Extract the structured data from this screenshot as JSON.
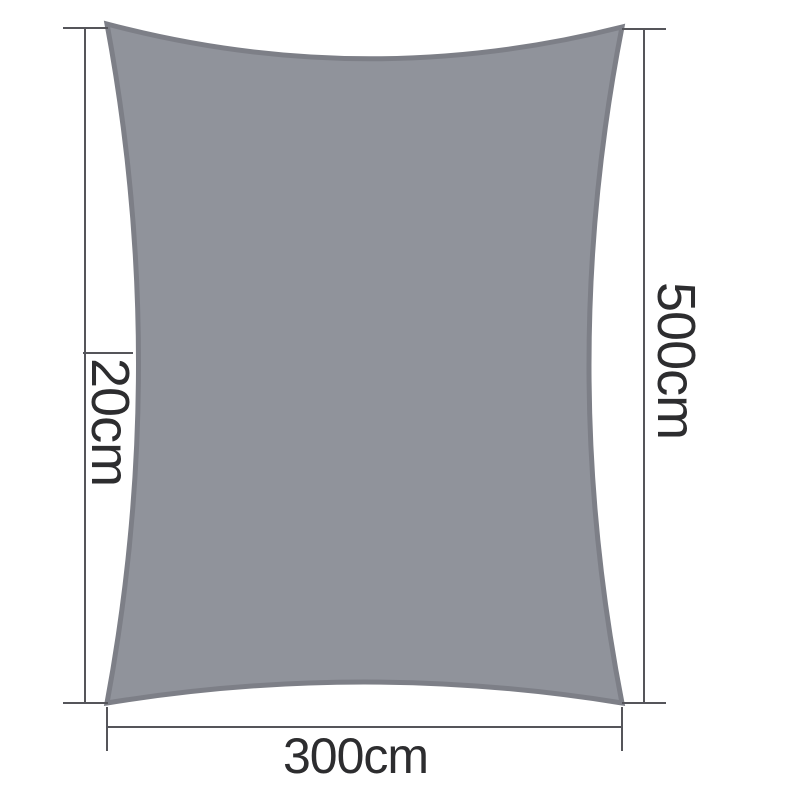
{
  "diagram": {
    "labels": {
      "curve_depth": "20cm",
      "height": "500cm",
      "width": "300cm"
    },
    "colors": {
      "sail_fill": "#90939B",
      "sail_border": "#7D7F87",
      "dimension_line": "#55555A",
      "label_text": "#2D2D2F",
      "background": "#FFFFFF"
    }
  }
}
